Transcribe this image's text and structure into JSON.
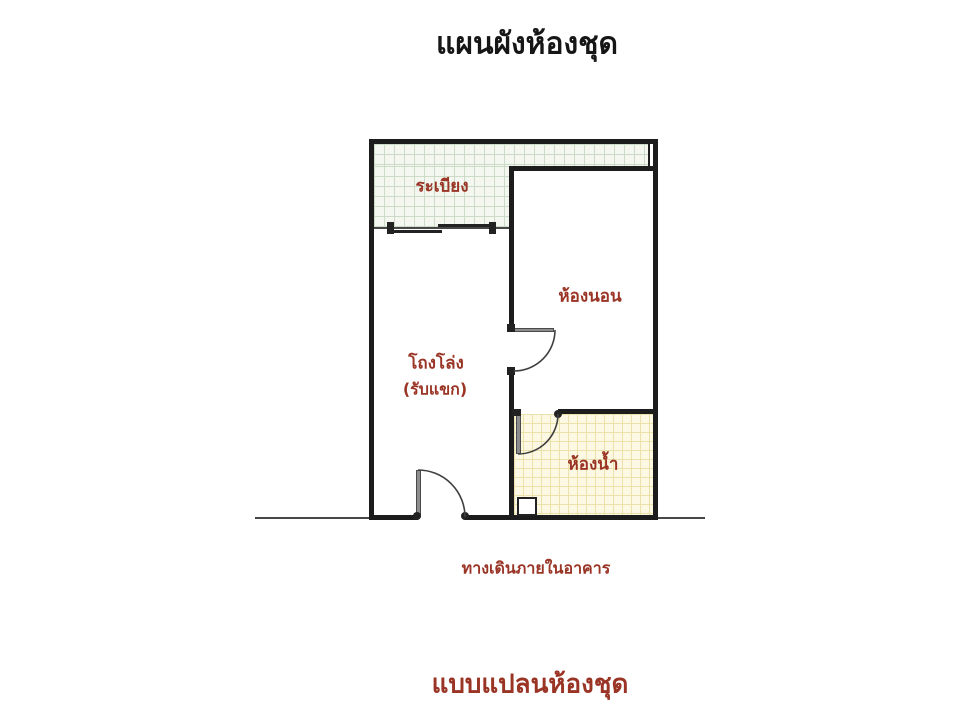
{
  "page": {
    "title": "แผนผังห้องชุด",
    "caption": "แบบแปลนห้องชุด"
  },
  "plan": {
    "rooms": {
      "balcony": {
        "label": "ระเบียง"
      },
      "bedroom": {
        "label": "ห้องนอน"
      },
      "hall": {
        "label": "โถงโล่ง",
        "sublabel": "(รับแขก)"
      },
      "bathroom": {
        "label": "ห้องน้ำ"
      }
    },
    "corridor_label": "ทางเดินภายในอาคาร",
    "features": {
      "balcony_door": "sliding-door",
      "bedroom_door": "swing-door",
      "bathroom_door": "swing-door",
      "entrance_door": "swing-door"
    },
    "colors": {
      "label_red": "#9a3526",
      "wall_black": "#1c1c1c",
      "balcony_fill": "#f3f7f0",
      "balcony_grid": "#ccdbc7",
      "bathroom_fill": "#fdf8e3",
      "bathroom_grid": "#eae2a9"
    }
  }
}
